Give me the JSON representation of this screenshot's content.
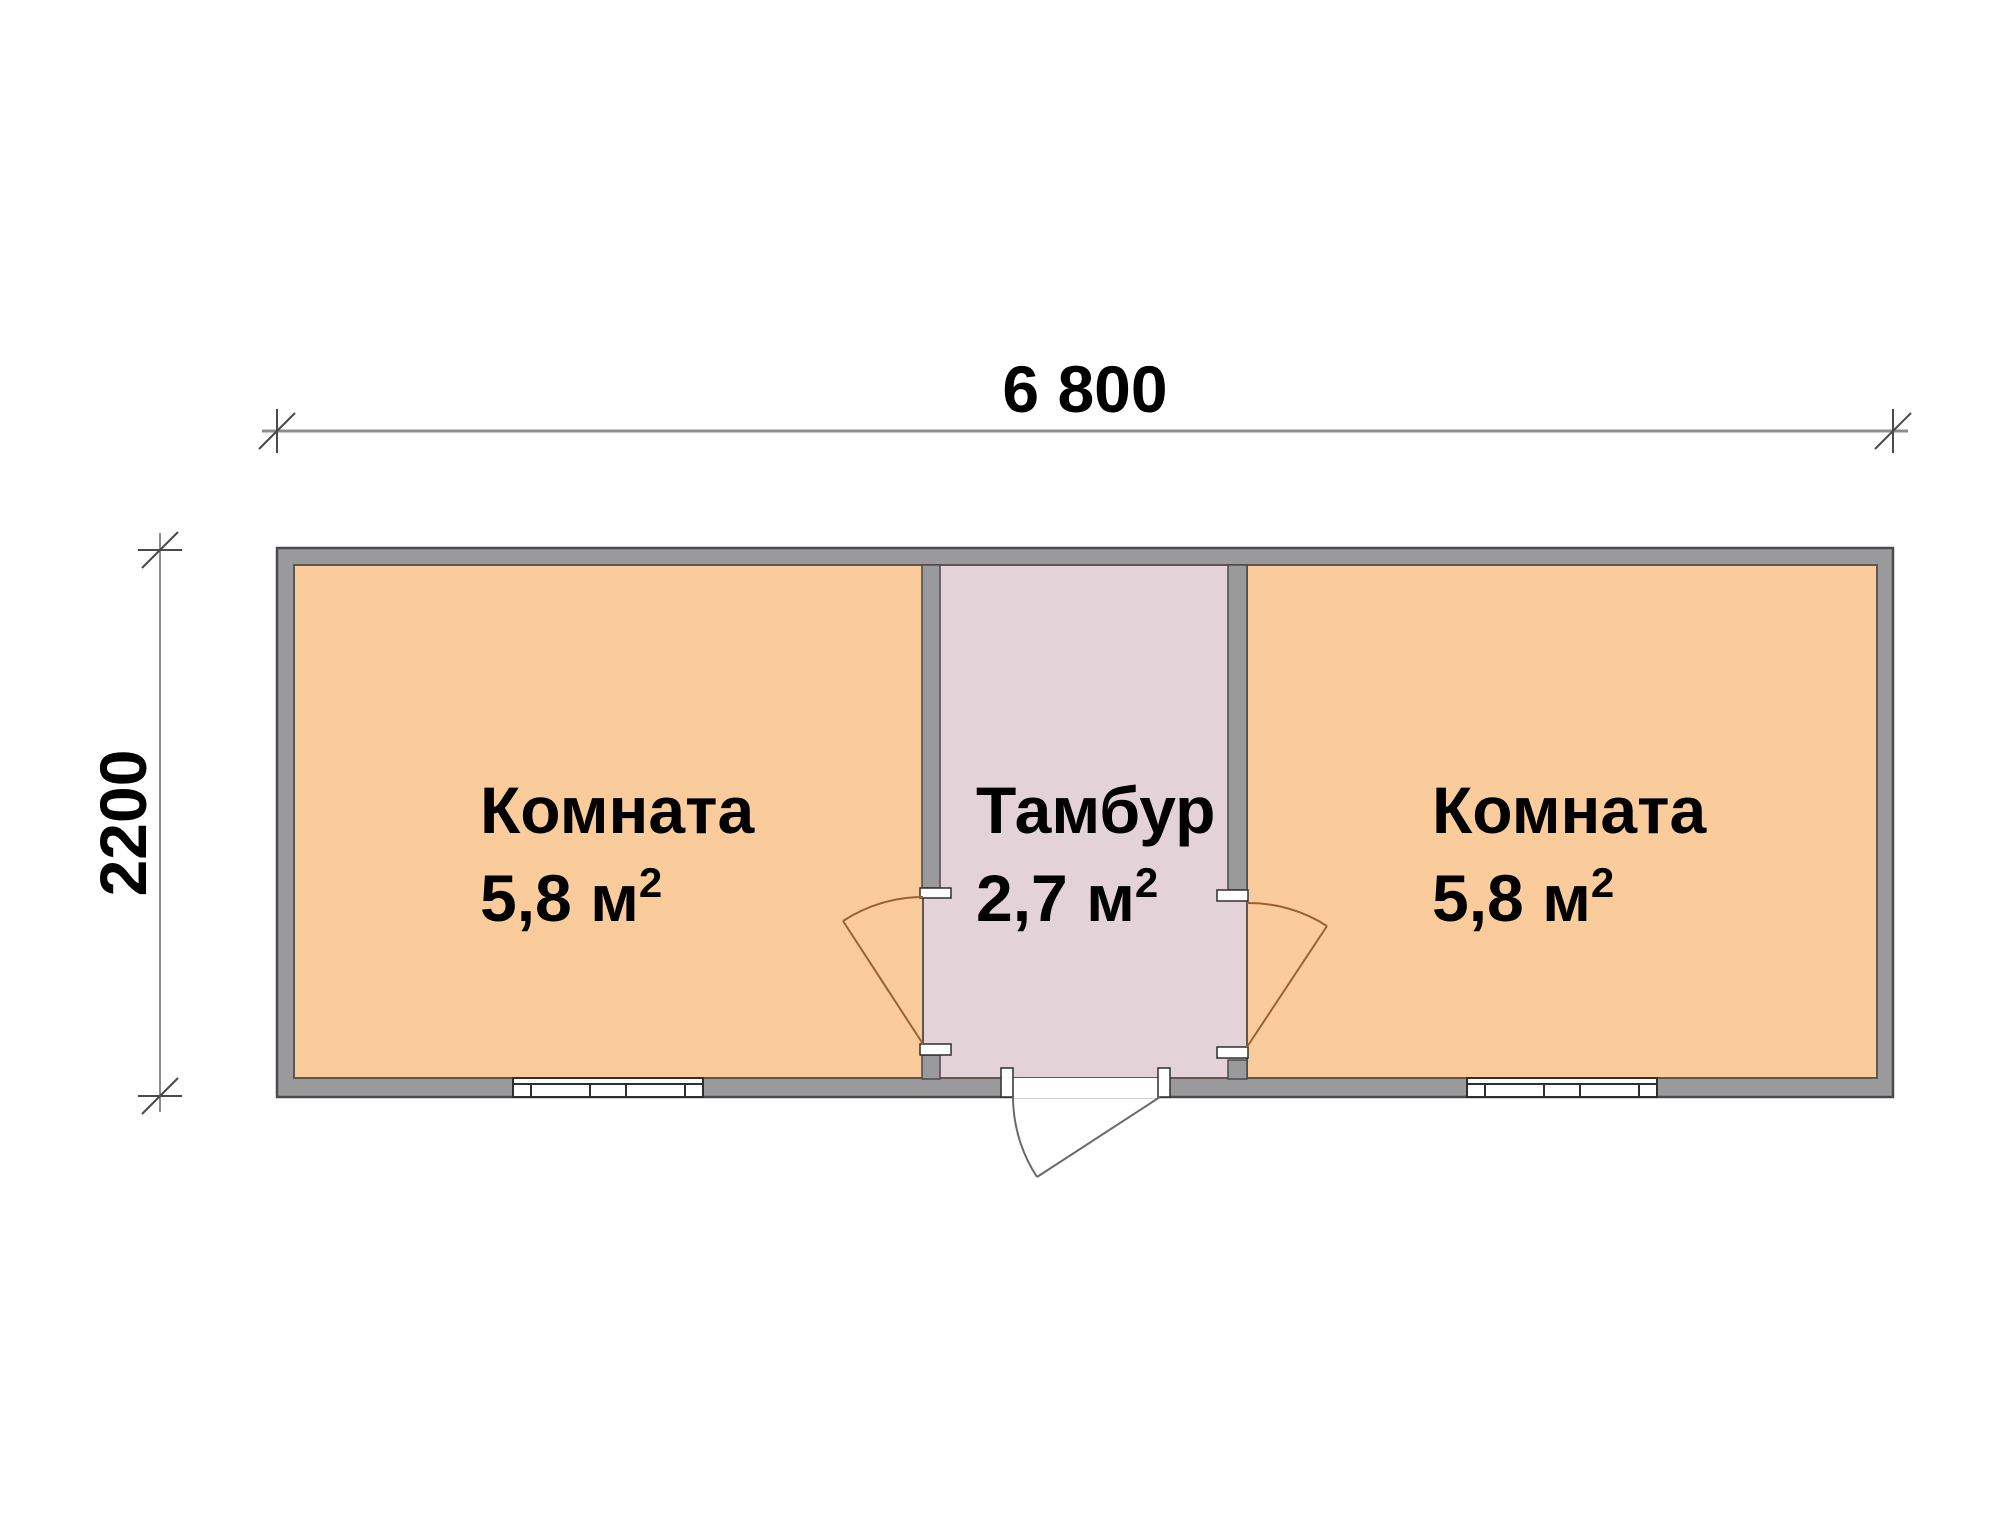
{
  "drawing": {
    "type": "floor-plan",
    "overall_width_mm": "6 800",
    "overall_depth_mm": "2200"
  },
  "dimensions": {
    "top_label": "6 800",
    "left_label": "2200"
  },
  "rooms": {
    "left": {
      "name": "Комната",
      "area": "5,8",
      "unit": "м",
      "sup": "2"
    },
    "tambur": {
      "name": "Тамбур",
      "area": "2,7",
      "unit": "м",
      "sup": "2"
    },
    "right": {
      "name": "Комната",
      "area": "5,8",
      "unit": "м",
      "sup": "2"
    }
  },
  "colors": {
    "page_bg": "#ffffff",
    "wall_fill": "#9a9a9c",
    "wall_stroke": "#4b4b4d",
    "room_fill": "#facc9b",
    "tambur_fill": "#e3d2d8",
    "room_stroke": "#5f574f",
    "door_line": "#9a6233",
    "ext_door_line": "#6a6a6a",
    "dim_line": "#8d8d8d",
    "tick_line": "#4a4a4a",
    "window_line": "#2f2f2f",
    "jamb_fill": "#ffffff",
    "text_color": "#000000"
  }
}
